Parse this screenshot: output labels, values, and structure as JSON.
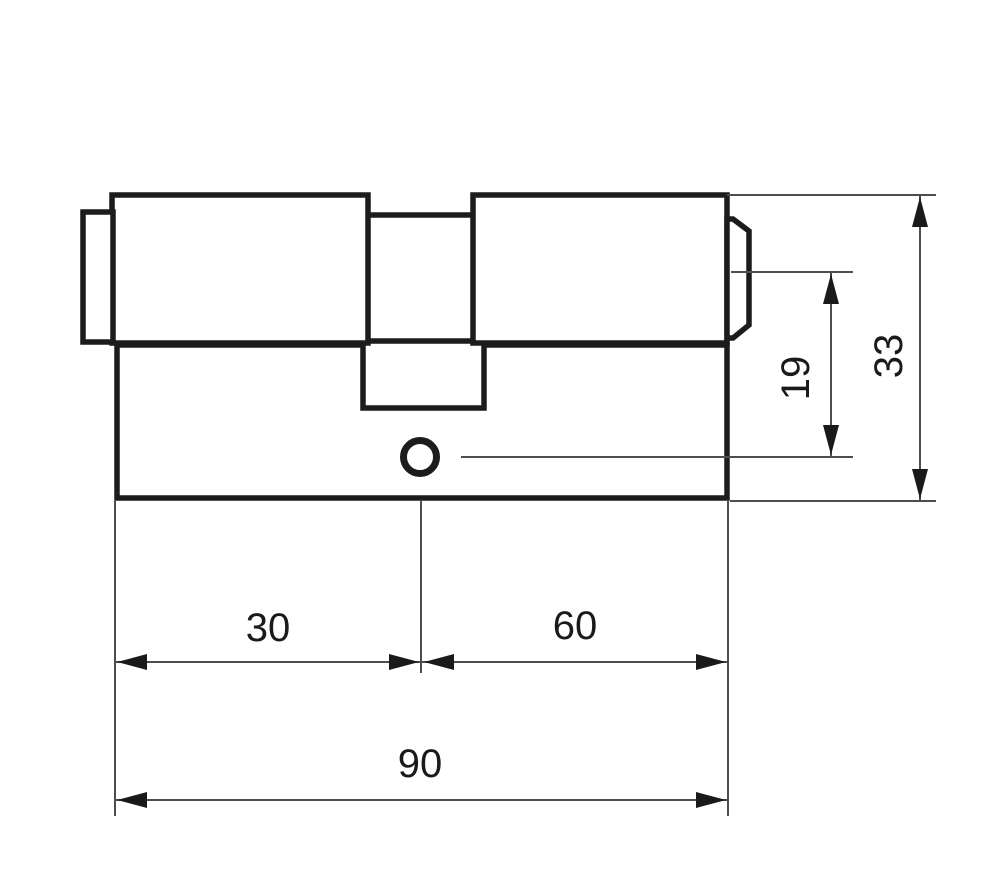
{
  "drawing": {
    "kind": "lock-cylinder-technical-drawing",
    "labels": {
      "left_segment": "30",
      "right_segment": "60",
      "total_length": "90",
      "cam_height": "19",
      "total_height": "33"
    },
    "colors": {
      "background": "#ffffff",
      "outline": "#1c1c1c",
      "dimension_line": "#4d4d4d",
      "arrow": "#1a1a1a",
      "text": "#1a1a1a"
    }
  }
}
